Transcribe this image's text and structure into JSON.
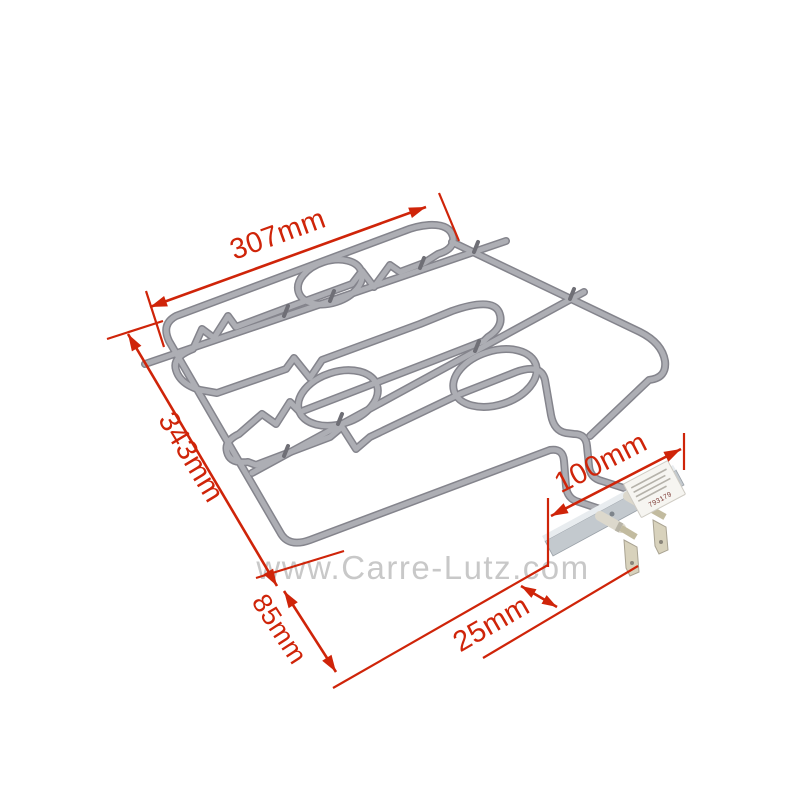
{
  "page": {
    "background": "#ffffff"
  },
  "watermark": {
    "text": "www.Carre-Lutz.com",
    "color": "#c6c6c6"
  },
  "annotation": {
    "color": "#cf2409"
  },
  "dimensions": {
    "top_width": "307mm",
    "left_depth": "343mm",
    "left_drop": "85mm",
    "terminal_length": "100mm",
    "terminal_offset": "25mm"
  },
  "element": {
    "tube_color_outer": "#84848c",
    "tube_color_inner": "#adaeb4",
    "bracket_label_number": "793179"
  }
}
